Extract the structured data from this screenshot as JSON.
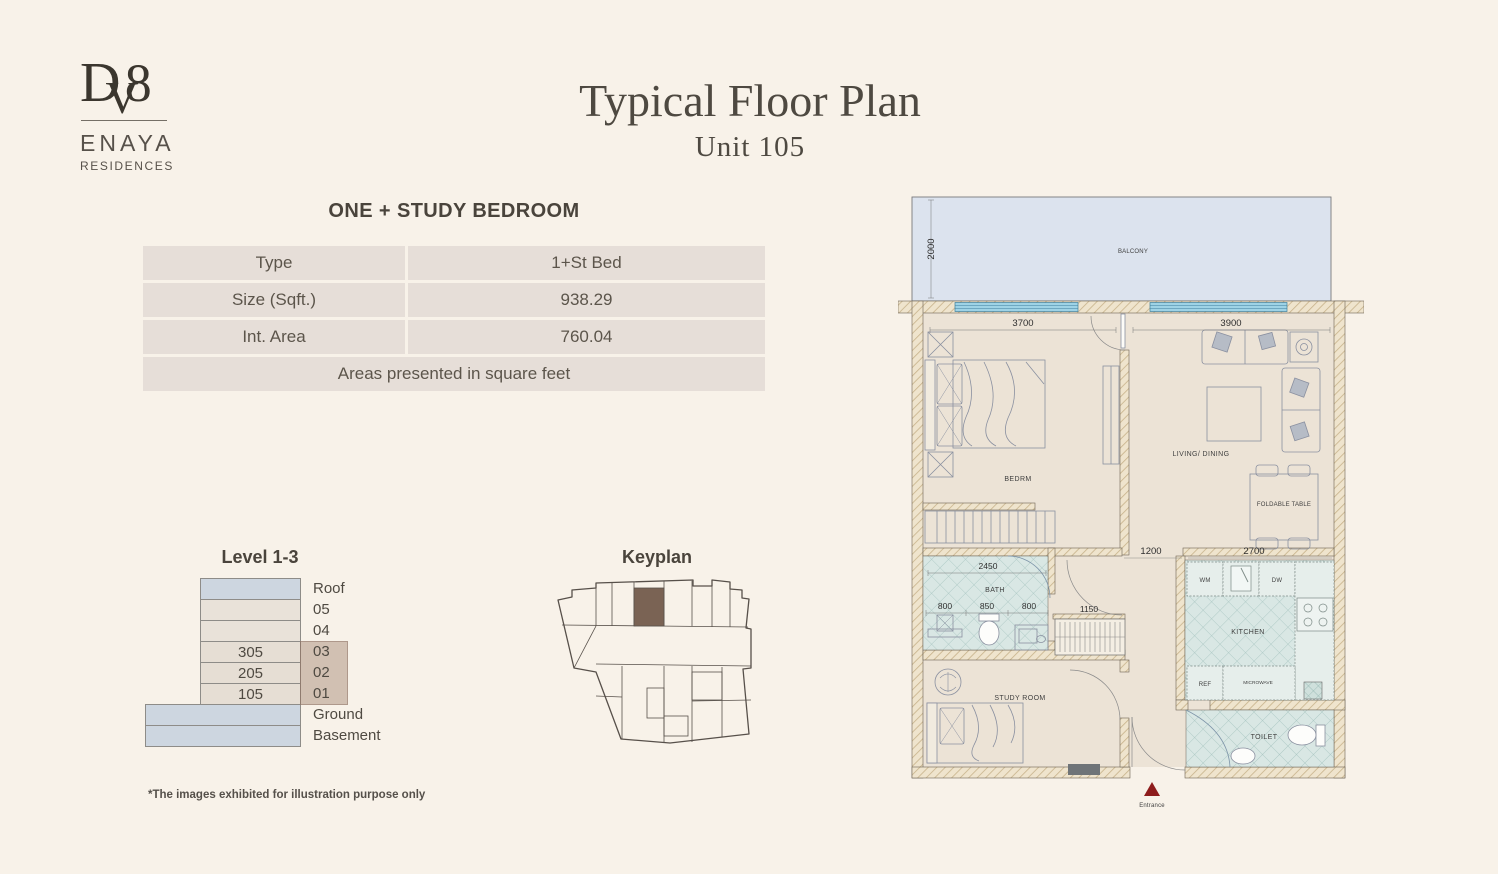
{
  "logo": {
    "monogram_d": "D",
    "monogram_v": "V",
    "monogram_8": "8",
    "name": "ENAYA",
    "subname": "RESIDENCES"
  },
  "header": {
    "title": "Typical Floor Plan",
    "subtitle": "Unit 105"
  },
  "unit_info": {
    "section_title": "ONE + STUDY BEDROOM",
    "rows": [
      {
        "label": "Type",
        "value": "1+St Bed"
      },
      {
        "label": "Size (Sqft.)",
        "value": "938.29"
      },
      {
        "label": "Int. Area",
        "value": "760.04"
      }
    ],
    "note": "Areas presented in square feet"
  },
  "levels": {
    "title": "Level 1-3",
    "floors": [
      {
        "label": "Roof",
        "unit": ""
      },
      {
        "label": "05",
        "unit": ""
      },
      {
        "label": "04",
        "unit": ""
      },
      {
        "label": "03",
        "unit": "305"
      },
      {
        "label": "02",
        "unit": "205"
      },
      {
        "label": "01",
        "unit": "105"
      },
      {
        "label": "Ground",
        "unit": ""
      },
      {
        "label": "Basement",
        "unit": ""
      }
    ]
  },
  "keyplan": {
    "title": "Keyplan"
  },
  "floorplan": {
    "labels": {
      "balcony": "BALCONY",
      "bedroom": "BEDRM",
      "living": "LIVING/ DINING",
      "foldable_table": "FOLDABLE TABLE",
      "bath": "BATH",
      "kitchen": "KITCHEN",
      "wm": "WM",
      "dw": "DW",
      "ref": "REF",
      "microwave": "MICROWAVE",
      "study": "STUDY ROOM",
      "toilet": "TOILET",
      "entrance": "Entrance"
    },
    "dimensions": {
      "balcony_depth": "2000",
      "bedroom_width": "3700",
      "living_width": "3900",
      "bath_width": "2450",
      "bath_a": "800",
      "bath_b": "850",
      "bath_c": "800",
      "closet_width": "1150",
      "hall_opening": "1200",
      "kitchen_width": "2700"
    }
  },
  "footnote": "*The images exhibited for illustration purpose only",
  "colors": {
    "page_bg": "#f8f2e9",
    "table_cell": "#e6ded8",
    "balcony_fill": "#dce3ee",
    "window_blue": "#9ed3e6",
    "tile": "#d9e7e4",
    "wall_hatch": "#efe4cd",
    "level_blue": "#cdd6e0",
    "level_beige": "#e9e2d9",
    "highlight_taupe": "#a88a78",
    "keyplan_unit_brown": "#7a6354",
    "entrance_red": "#8e1c1c"
  }
}
